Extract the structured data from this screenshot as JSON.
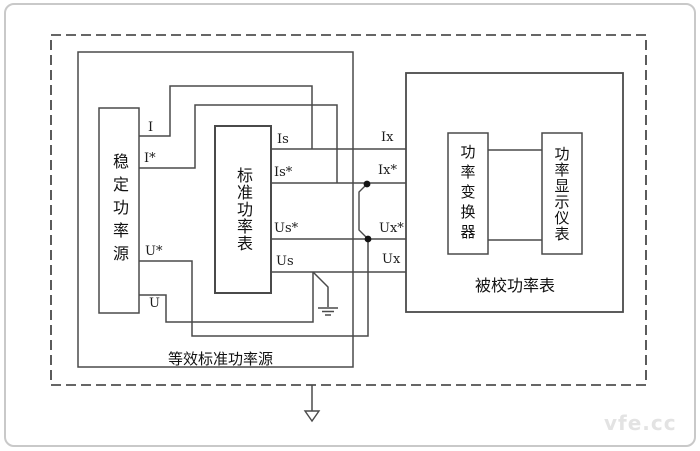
{
  "diagram": {
    "title_note": "power meter calibration wiring diagram",
    "colors": {
      "line": "#4a4a4a",
      "dash": "#333333",
      "text": "#111111",
      "watermark": "#e3e3e3"
    },
    "blocks": {
      "stable_source": {
        "label": "稳定功率源"
      },
      "standard_meter": {
        "label": "标准功率表"
      },
      "equivalent_source": {
        "label": "等效标准功率源"
      },
      "dut": {
        "label": "被校功率表"
      },
      "converter": {
        "label": "功率变换器"
      },
      "display": {
        "label": "功率显示仪表"
      }
    },
    "terminals": {
      "i": "I",
      "i_star": "I*",
      "u_star": "U*",
      "u": "U",
      "is": "Is",
      "is_star": "Is*",
      "us_star": "Us*",
      "us": "Us",
      "ix": "Ix",
      "ix_star": "Ix*",
      "ux_star": "Ux*",
      "ux": "Ux"
    },
    "icons": {
      "ground": "ground-icon",
      "arrow": "down-arrow-icon"
    },
    "watermark": "vfe.cc"
  }
}
